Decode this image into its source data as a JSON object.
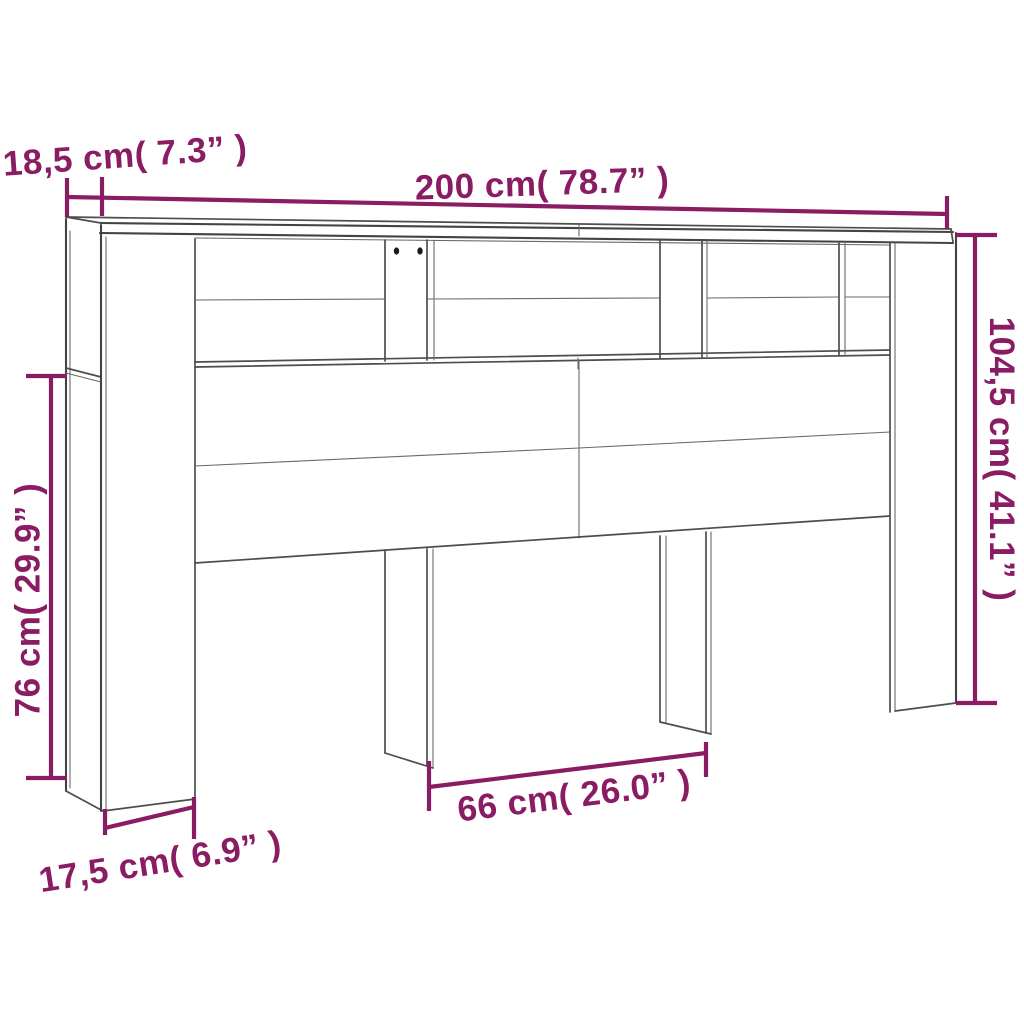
{
  "diagram": {
    "kind": "furniture-dimension-diagram",
    "style": {
      "accent_color": "#8A1C64",
      "line_color": "#4D4D4D",
      "dot_color": "#1A1A1A",
      "background": "#FFFFFF"
    },
    "dimensions": {
      "top_depth": {
        "label": "18,5 cm( 7.3” )",
        "cm": "18,5",
        "inches": "7.3"
      },
      "width": {
        "label": "200 cm( 78.7” )",
        "cm": "200",
        "inches": "78.7"
      },
      "height": {
        "label": "104,5 cm( 41.1” )",
        "cm": "104,5",
        "inches": "41.1"
      },
      "front_height": {
        "label": "76 cm( 29.9” )",
        "cm": "76",
        "inches": "29.9"
      },
      "center_opening_width": {
        "label": "66 cm( 26.0” )",
        "cm": "66",
        "inches": "26.0"
      },
      "side_column_width": {
        "label": "17,5 cm( 6.9” )",
        "cm": "17,5",
        "inches": "6.9"
      }
    }
  }
}
